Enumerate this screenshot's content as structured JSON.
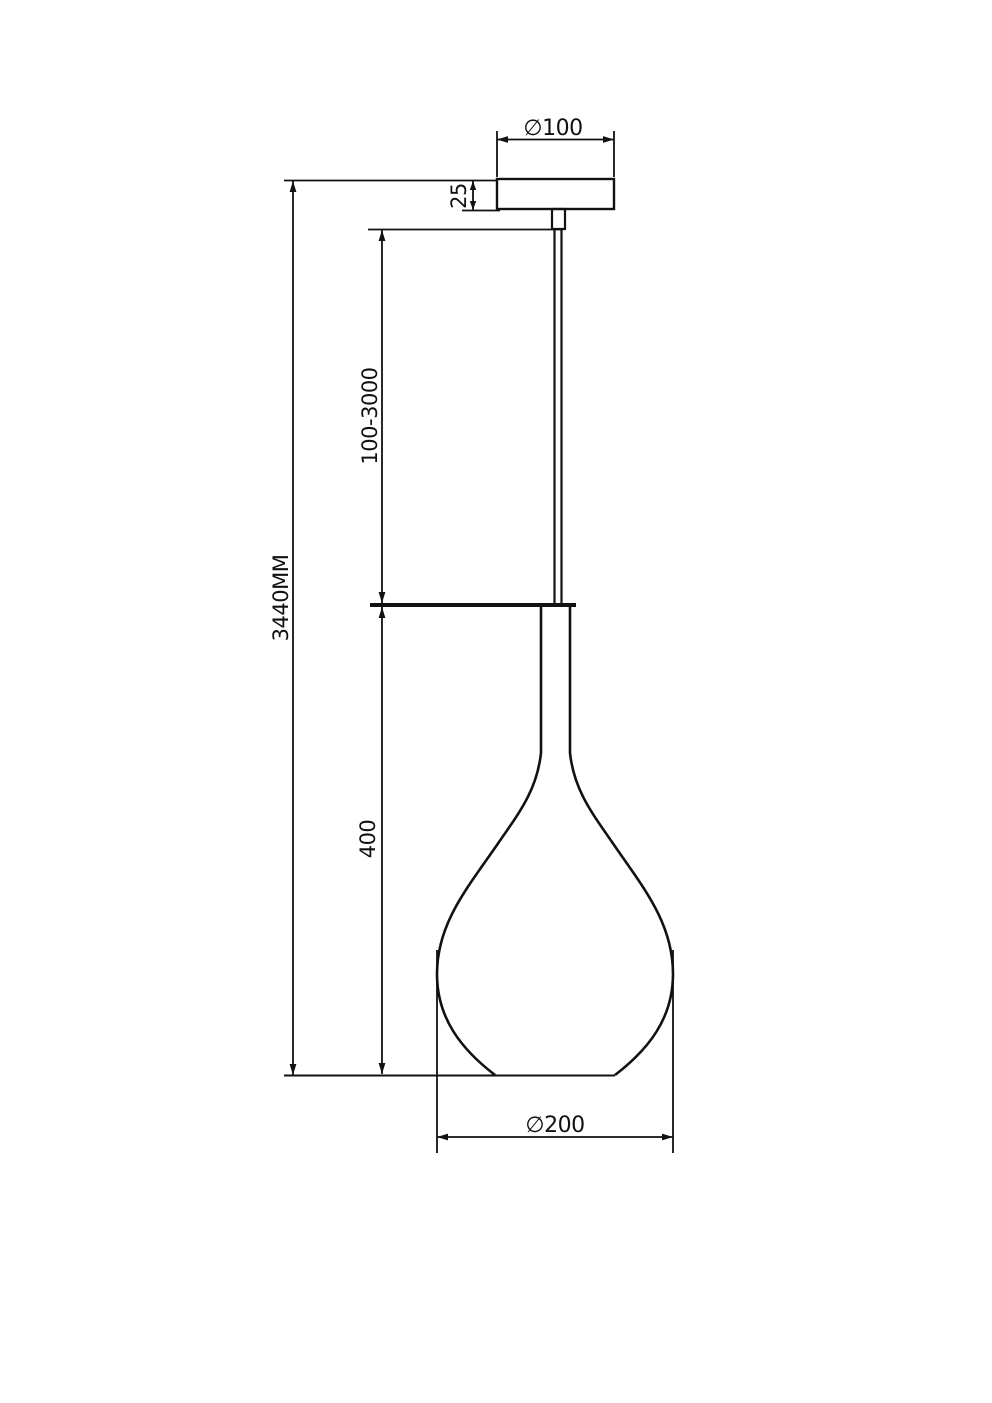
{
  "page": {
    "background": "#ffffff",
    "line_color": "#111111"
  },
  "drawing": {
    "kind": "pendant-lamp-dimension-drawing",
    "labels": {
      "canopy_diameter": "∅100",
      "canopy_height": "25",
      "suspension_length": "100-3000",
      "overall_height": "3440MM",
      "shade_height": "400",
      "shade_diameter": "∅200"
    }
  }
}
